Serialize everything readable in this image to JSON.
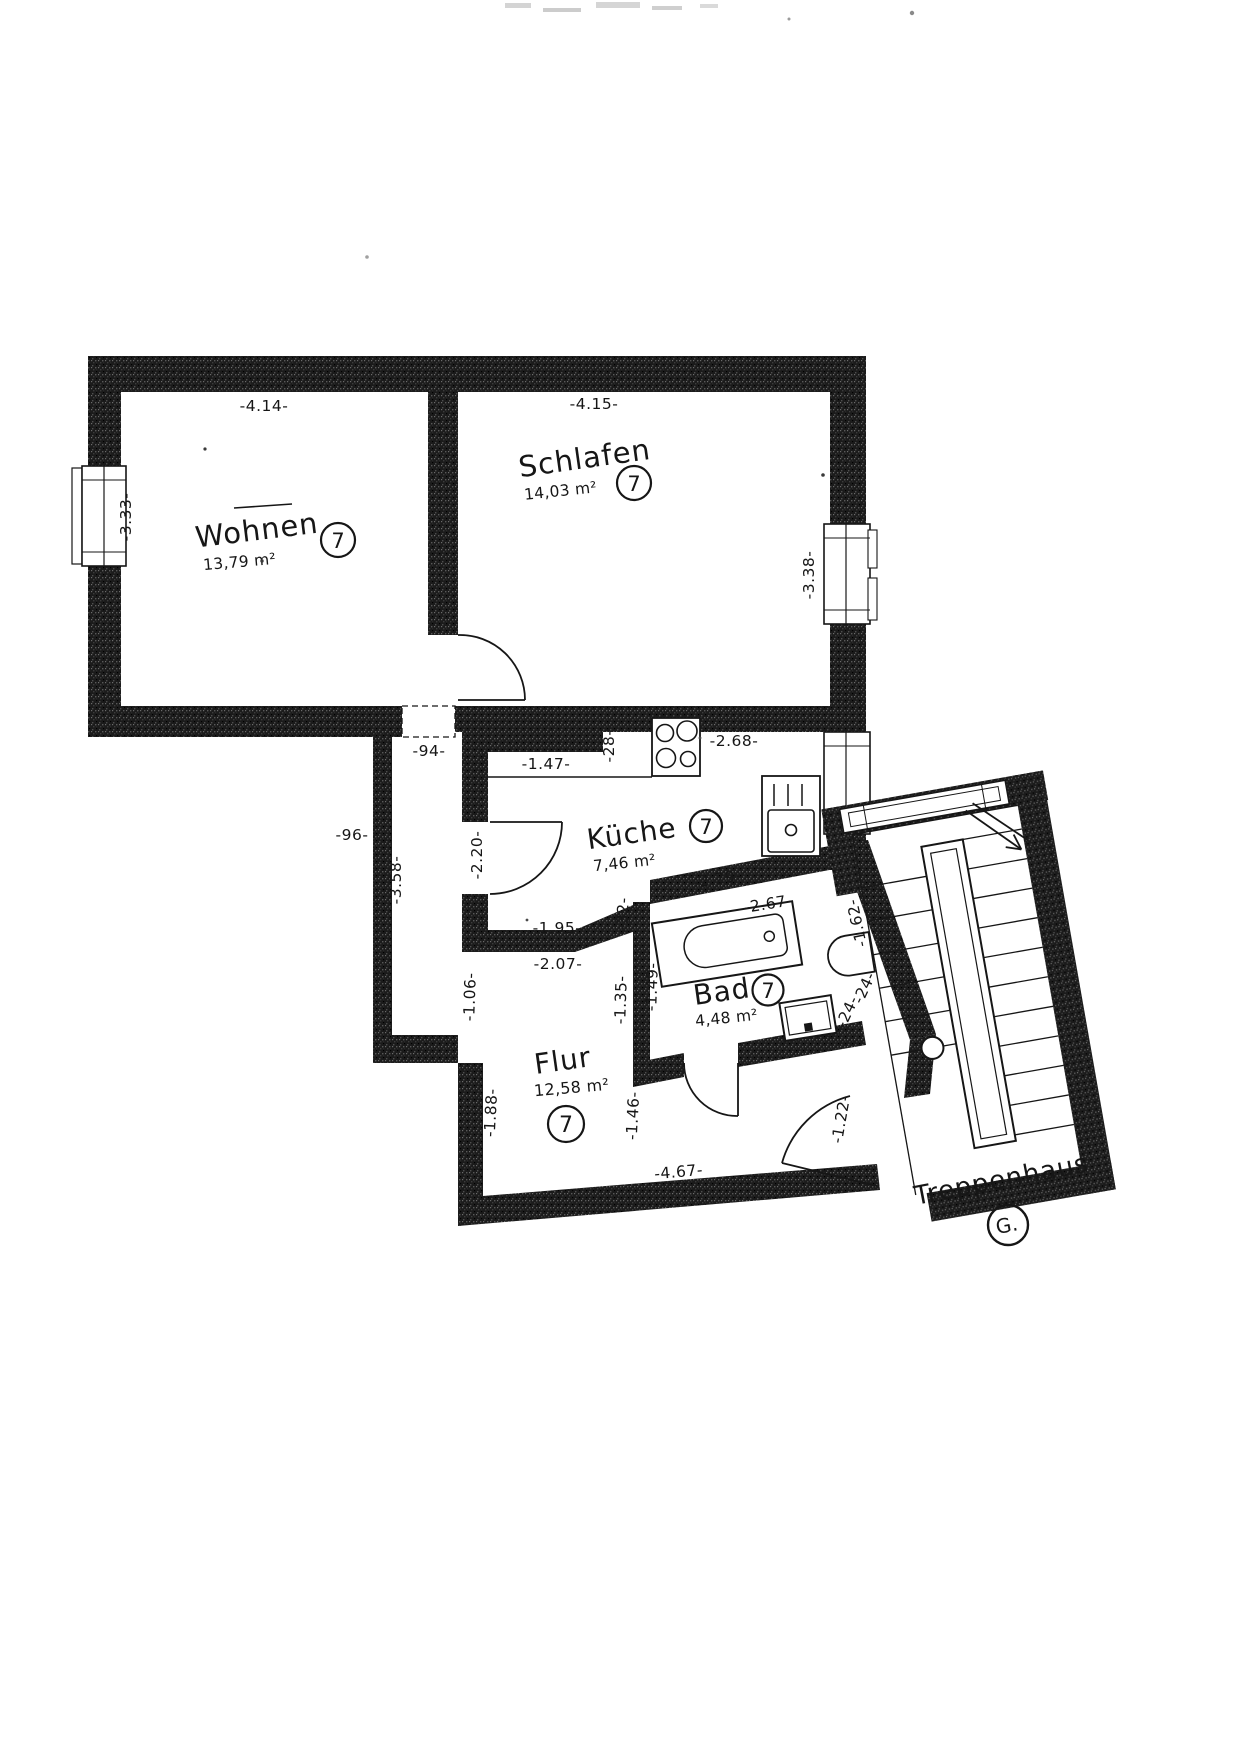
{
  "document": {
    "kind": "scanned floor plan",
    "floor_label": "G."
  },
  "rooms": [
    {
      "id": "wohnen",
      "name": "Wohnen",
      "area": "13,79 m²",
      "unit": "7"
    },
    {
      "id": "schlafen",
      "name": "Schlafen",
      "area": "14,03 m²",
      "unit": "7"
    },
    {
      "id": "kueche",
      "name": "Küche",
      "area": "7,46 m²",
      "unit": "7"
    },
    {
      "id": "bad",
      "name": "Bad",
      "area": "4,48 m²",
      "unit": "7"
    },
    {
      "id": "flur",
      "name": "Flur",
      "area": "12,58 m²",
      "unit": "7"
    },
    {
      "id": "treppenhaus",
      "name": "Treppenhaus",
      "label": "G."
    }
  ],
  "dimensions": {
    "d414": "-4.14-",
    "d415": "-4.15-",
    "d333": "-3.33-",
    "d338": "-3.38-",
    "d94": "-94-",
    "d96": "-96-",
    "d358": "-3.58-",
    "d147": "-1.47-",
    "d28": "-28-",
    "d268": "-2.68-",
    "d220": "-2.20-",
    "d195": "-1.95-",
    "d207": "-2.07-",
    "d32": "-32-",
    "d229": "-2.29-",
    "d267": "-2.67-",
    "d149": "-1.49-",
    "d135": "-1.35-",
    "d106": "-1.06-",
    "d162": "-1.62-",
    "d24a": "-24-",
    "d24b": "-24-",
    "d188": "-1.88-",
    "d146": "-1.46-",
    "d122": "-1.22-",
    "d467": "-4.67-"
  },
  "colors": {
    "paper": "#ffffff",
    "ink": "#161616",
    "wall": "#1b1b1b"
  }
}
